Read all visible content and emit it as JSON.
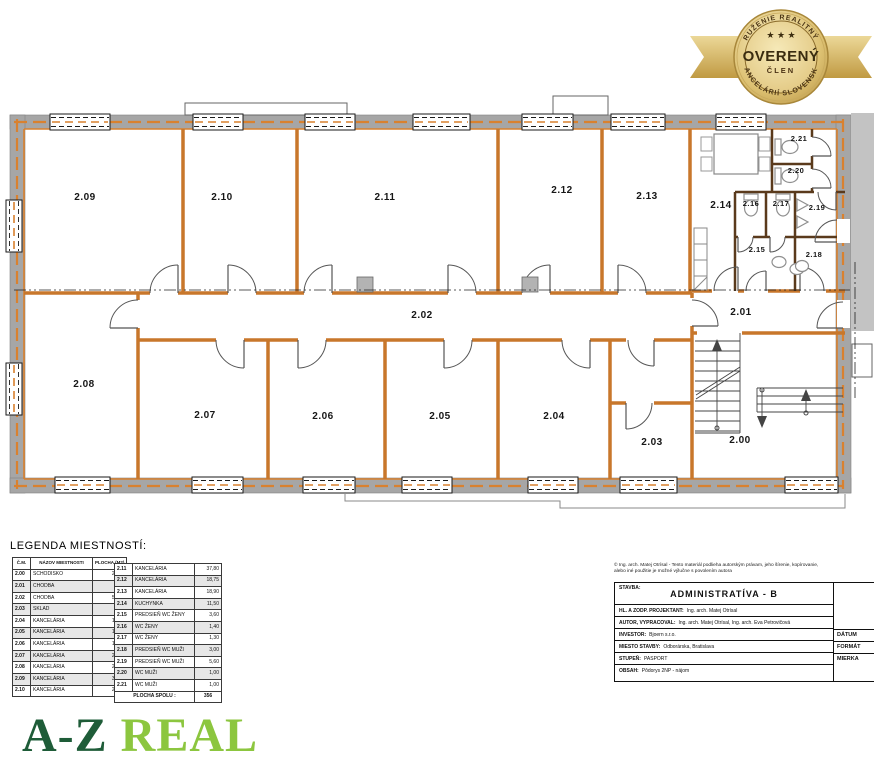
{
  "badge": {
    "arc_top": "ZDRUŽENIE REALITNÝCH",
    "stars": "★ ★ ★",
    "title": "OVERENÝ",
    "subtitle": "ČLEN",
    "arc_bottom": "KANCELÁRIÍ SLOVENSKA"
  },
  "plan": {
    "rooms": [
      {
        "label": "2.09",
        "x": 85,
        "y": 200
      },
      {
        "label": "2.10",
        "x": 222,
        "y": 200
      },
      {
        "label": "2.11",
        "x": 385,
        "y": 200
      },
      {
        "label": "2.12",
        "x": 562,
        "y": 193
      },
      {
        "label": "2.13",
        "x": 647,
        "y": 199
      },
      {
        "label": "2.14",
        "x": 721,
        "y": 208
      },
      {
        "label": "2.15",
        "x": 757,
        "y": 252,
        "small": true
      },
      {
        "label": "2.16",
        "x": 751,
        "y": 206,
        "small": true
      },
      {
        "label": "2.17",
        "x": 781,
        "y": 206,
        "small": true
      },
      {
        "label": "2.18",
        "x": 814,
        "y": 257,
        "small": true
      },
      {
        "label": "2.19",
        "x": 817,
        "y": 210,
        "small": true
      },
      {
        "label": "2.20",
        "x": 796,
        "y": 173,
        "small": true
      },
      {
        "label": "2.21",
        "x": 799,
        "y": 141,
        "small": true
      },
      {
        "label": "2.02",
        "x": 422,
        "y": 318
      },
      {
        "label": "2.01",
        "x": 741,
        "y": 315
      },
      {
        "label": "2.00",
        "x": 740,
        "y": 443
      },
      {
        "label": "2.03",
        "x": 652,
        "y": 445
      },
      {
        "label": "2.04",
        "x": 554,
        "y": 419
      },
      {
        "label": "2.05",
        "x": 440,
        "y": 419
      },
      {
        "label": "2.06",
        "x": 323,
        "y": 419
      },
      {
        "label": "2.07",
        "x": 205,
        "y": 418
      },
      {
        "label": "2.08",
        "x": 84,
        "y": 387
      }
    ]
  },
  "legend": {
    "title": "LEGENDA MIESTNOSTÍ:",
    "headers": [
      "Č.M.",
      "NÁZOV MIESTNOSTI",
      "PLOCHA (M2)"
    ],
    "left_rows": [
      [
        "2.00",
        "SCHODISKO",
        "24,80"
      ],
      [
        "2.01",
        "CHODBA",
        "7,10"
      ],
      [
        "2.02",
        "CHODBA",
        "56,80"
      ],
      [
        "2.03",
        "SKLAD",
        "7,40"
      ],
      [
        "2.04",
        "KANCELÁRIA",
        "19,20"
      ],
      [
        "2.05",
        "KANCELÁRIA",
        "19,00"
      ],
      [
        "2.06",
        "KANCELÁRIA",
        "18,50"
      ],
      [
        "2.07",
        "KANCELÁRIA",
        "21,10"
      ],
      [
        "2.08",
        "KANCELÁRIA",
        "25,40"
      ],
      [
        "2.09",
        "KANCELÁRIA",
        "31,20"
      ],
      [
        "2.10",
        "KANCELÁRIA",
        "21,40"
      ]
    ],
    "right_rows": [
      [
        "2.11",
        "KANCELÁRIA",
        "37,80"
      ],
      [
        "2.12",
        "KANCELÁRIA",
        "18,75"
      ],
      [
        "2.13",
        "KANCELÁRIA",
        "18,90"
      ],
      [
        "2.14",
        "KUCHYNKA",
        "11,50"
      ],
      [
        "2.15",
        "PREDSIEŇ WC ŽENY",
        "3,60"
      ],
      [
        "2.16",
        "WC ŽENY",
        "1,40"
      ],
      [
        "2.17",
        "WC ŽENY",
        "1,30"
      ],
      [
        "2.18",
        "PREDSIEŇ WC MUŽI",
        "3,00"
      ],
      [
        "2.19",
        "PREDSIEŇ WC MUŽI",
        "5,60"
      ],
      [
        "2.20",
        "WC MUŽI",
        "1,00"
      ],
      [
        "2.21",
        "WC MUŽI",
        "1,00"
      ]
    ],
    "total_label": "PLOCHA SPOLU :",
    "total_value": "356"
  },
  "titleblock": {
    "copyright_line1": "© Ing. arch. Matej Otrísal - Tento materiál podlieha autorským právam, jeho šírenie, kopírovanie,",
    "copyright_line2": "alebo iné použitie je možné výlučne s povolením autora",
    "stavba_label": "STAVBA:",
    "stavba_value": "ADMINISTRATÍVA - B",
    "rows": [
      {
        "label": "HL. A ZODP. PROJEKTANT:",
        "value": "Ing. arch. Matej Otrísal"
      },
      {
        "label": "AUTOR, VYPRACOVAL:",
        "value": "Ing. arch. Matej Otrísal, Ing. arch. Eva Petrovičová"
      },
      {
        "label": "INVESTOR:",
        "value": "Bjoern s.r.o."
      },
      {
        "label": "MIESTO STAVBY:",
        "value": "Odborárska, Bratislava"
      },
      {
        "label": "STUPEŇ:",
        "value": "PASPORT"
      },
      {
        "label": "OBSAH:",
        "value": "Pôdorys 2NP - nájom"
      }
    ],
    "side_labels": [
      "DÁTUM",
      "FORMÁT",
      "MIERKA"
    ]
  },
  "logo": {
    "part1": "A-Z",
    "part2": "REAL"
  },
  "colors": {
    "plan_orange": "#d9812f",
    "wall_gray": "#a6a6a6",
    "sanitary_brown": "#5a3a1c",
    "logo_dark_green": "#1e5c38",
    "logo_light_green": "#8cc63f",
    "badge_gold": "#d9bc6d"
  }
}
